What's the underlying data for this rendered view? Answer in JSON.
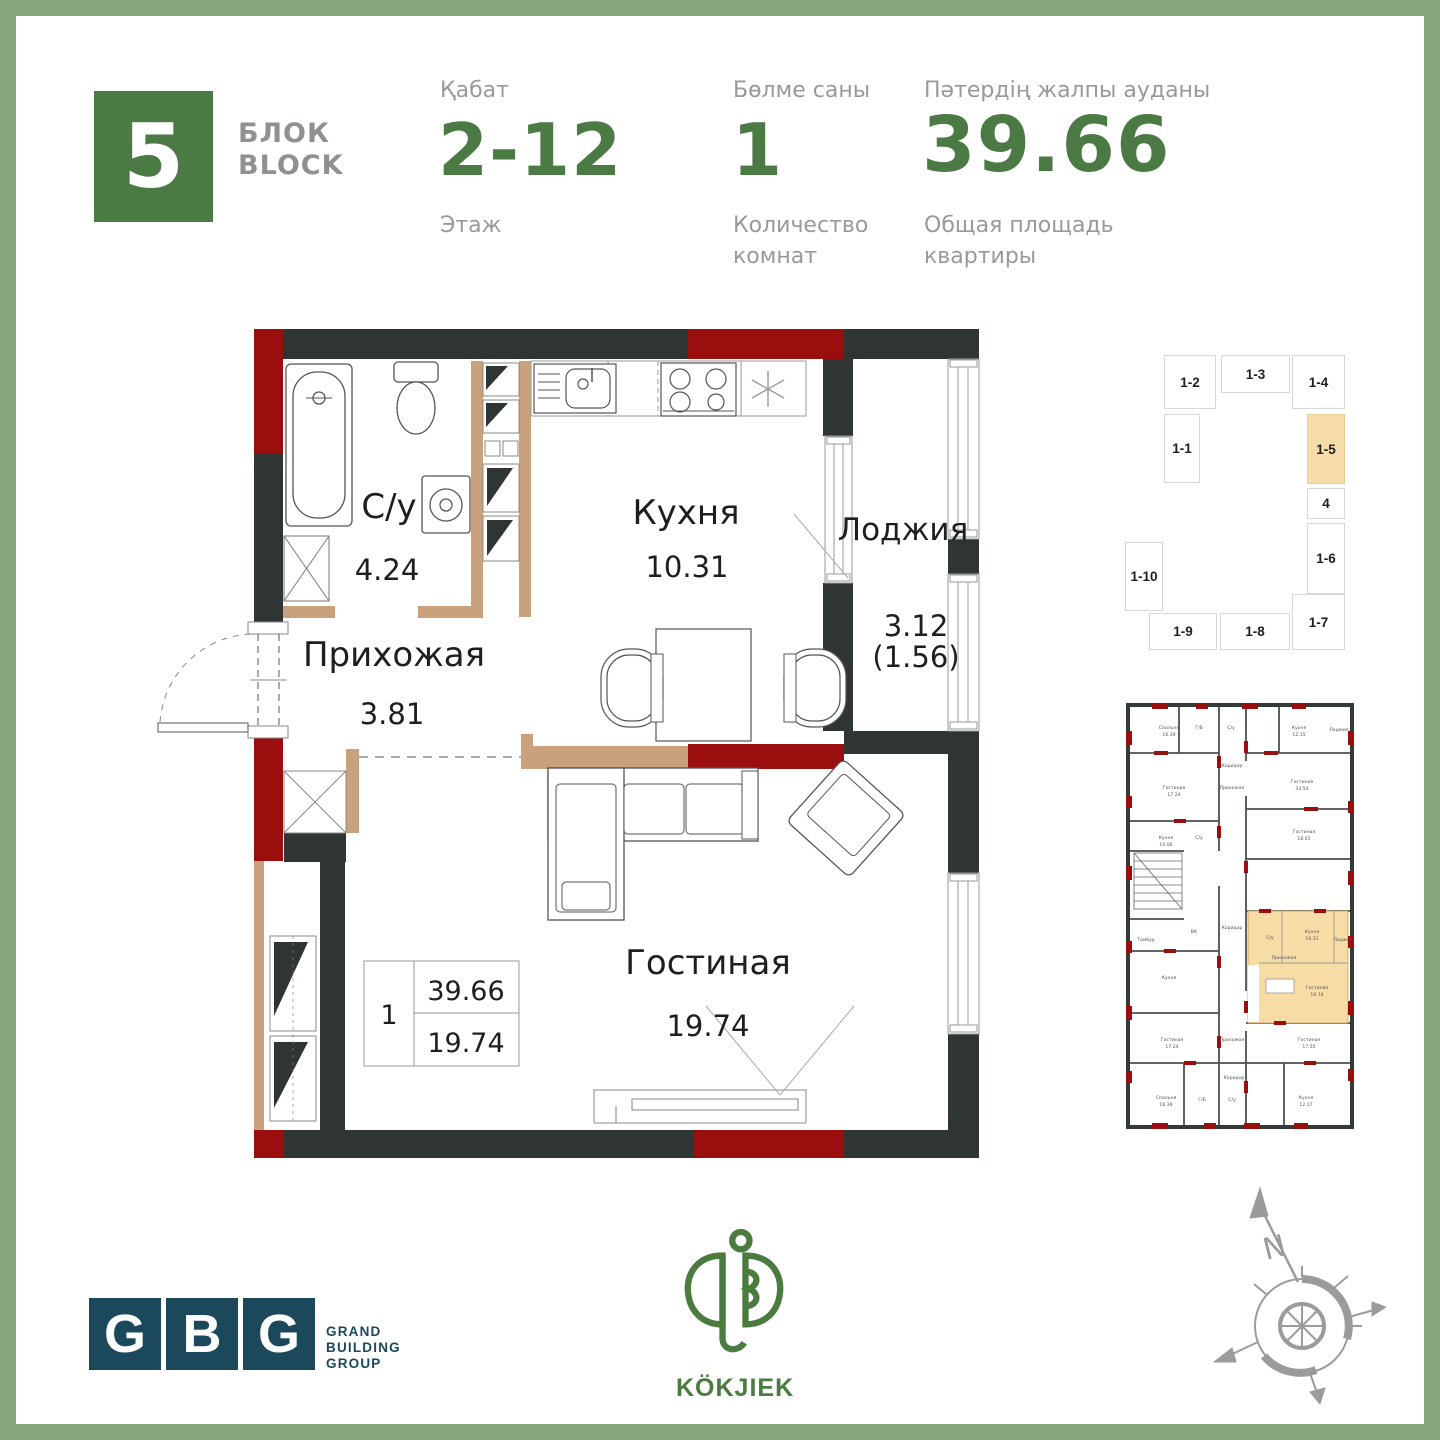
{
  "frame_color": "#85A77B",
  "header": {
    "block_number": "5",
    "block_label": "БЛОК\nBLOCK",
    "floor": {
      "label_kz": "Қабат",
      "value": "2-12",
      "label_ru": "Этаж"
    },
    "rooms": {
      "label_kz": "Бөлме саны",
      "value": "1",
      "label_ru": "Количество\nкомнат"
    },
    "area": {
      "label_kz": "Пәтердің жалпы ауданы",
      "value": "39.66",
      "label_ru": "Общая площадь\nквартиры"
    }
  },
  "plan": {
    "colors": {
      "wall": "#2E3532",
      "accent": "#9B0E0E",
      "partition": "#C9A17C"
    },
    "rooms": {
      "bathroom": {
        "name": "С/у",
        "area": "4.24"
      },
      "kitchen": {
        "name": "Кухня",
        "area": "10.31"
      },
      "loggia": {
        "name": "Лоджия",
        "area": "3.12",
        "area_half": "(1.56)"
      },
      "hall": {
        "name": "Прихожая",
        "area": "3.81"
      },
      "living": {
        "name": "Гостиная",
        "area": "19.74"
      }
    },
    "legend": {
      "rooms": "1",
      "total_area": "39.66",
      "living_area": "19.74"
    }
  },
  "key_plan": {
    "highlighted": "1-5",
    "highlight_color": "#F5DCA9",
    "units": [
      "1-2",
      "1-3",
      "1-4",
      "1-1",
      "1-5",
      "4",
      "1-6",
      "1-10",
      "1-9",
      "1-8",
      "1-7"
    ]
  },
  "mini_plan": {
    "labels": [
      "Спальня",
      "16.39",
      "Г/Б",
      "С/у",
      "Кухня",
      "12.15",
      "Лоджия",
      "Коридор",
      "Гостиная",
      "17.24",
      "Прихожая",
      "Гостиная",
      "33.54",
      "Кухня",
      "10.06",
      "С/у",
      "Гостиная",
      "18.01",
      "ВК",
      "Тамбур",
      "Коридор",
      "С/у",
      "Кухня",
      "10.31",
      "Прихожая",
      "Гостиная",
      "19.74",
      "Лоджия",
      "Кухня",
      "Гостиная",
      "17.24",
      "Прихожая",
      "Гостиная",
      "17.55",
      "Коридор",
      "Спальня",
      "16.39",
      "Г/Б",
      "С/у",
      "Кухня",
      "12.17"
    ]
  },
  "footer": {
    "gbg": {
      "letters": [
        "G",
        "B",
        "G"
      ],
      "name": "GRAND\nBUILDING\nGROUP",
      "color": "#1B485A"
    },
    "kokjiek": {
      "name": "KÖKJIEK",
      "color": "#4B7B3F"
    },
    "compass": {
      "north_label": "N"
    }
  }
}
